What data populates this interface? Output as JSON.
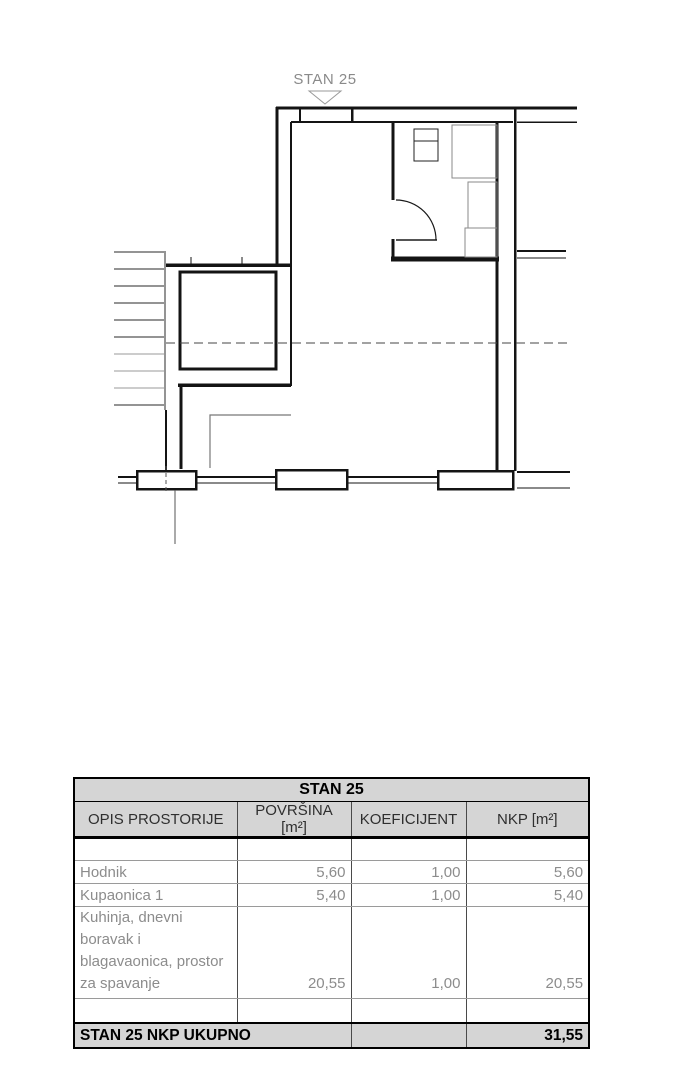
{
  "plan": {
    "label": "STAN 25"
  },
  "table": {
    "title": "STAN 25",
    "columns": [
      "OPIS PROSTORIJE",
      "POVRŠINA [m²]",
      "KOEFICIJENT",
      "NKP [m²]"
    ],
    "rows": [
      {
        "name": "Hodnik",
        "povrsina": "5,60",
        "koeficijent": "1,00",
        "nkp": "5,60"
      },
      {
        "name": "Kupaonica 1",
        "povrsina": "5,40",
        "koeficijent": "1,00",
        "nkp": "5,40"
      },
      {
        "name": "Kuhinja, dnevni boravak i blagavaonica, prostor za spavanje",
        "povrsina": "20,55",
        "koeficijent": "1,00",
        "nkp": "20,55"
      }
    ],
    "total_label": "STAN 25 NKP UKUPNO",
    "total_nkp": "31,55"
  }
}
